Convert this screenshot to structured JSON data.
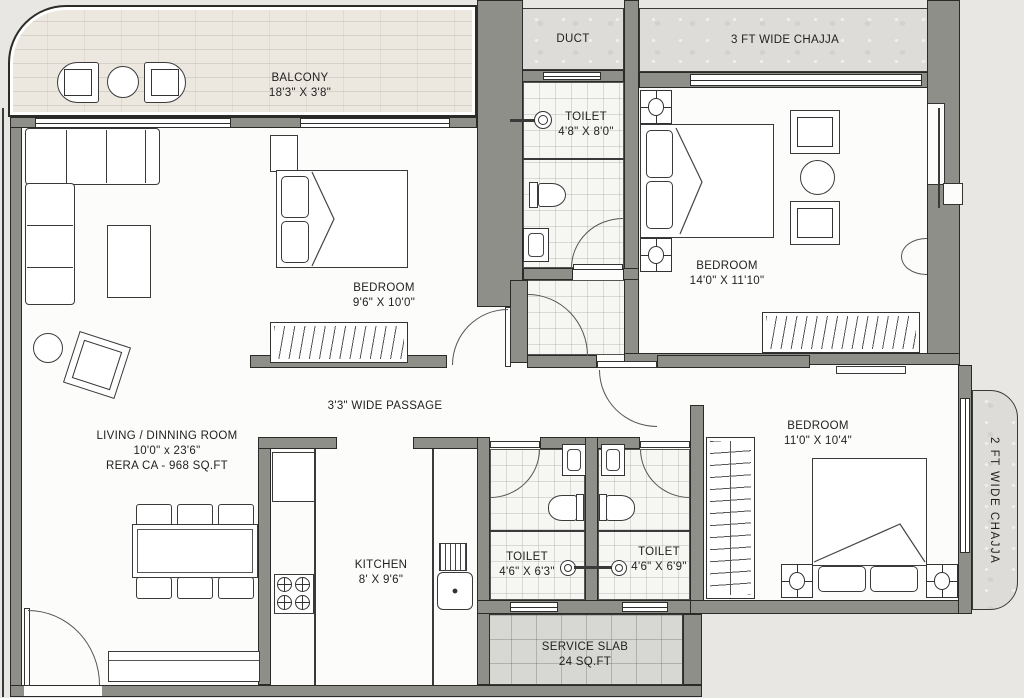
{
  "colors": {
    "background": "#e9e7e3",
    "wall": "#8f8f8a",
    "line": "#2a2a28",
    "floor": "#fcfcfa",
    "tile_floor": "#f6f6f3",
    "texture": "#dedcd8",
    "balcony_floor": "#ece8e0",
    "text": "#1f1f1f"
  },
  "rooms": {
    "balcony": {
      "label": "BALCONY",
      "dims": "18'3\" X 3'8\""
    },
    "duct": {
      "label": "DUCT"
    },
    "chajja_top": {
      "label": "3 FT WIDE CHAJJA"
    },
    "chajja_right": {
      "label": "2 FT WIDE CHAJJA"
    },
    "toilet_top": {
      "label": "TOILET",
      "dims": "4'8\" X 8'0\""
    },
    "bedroom_mid": {
      "label": "BEDROOM",
      "dims": "9'6\" X 10'0\""
    },
    "bedroom_top_right": {
      "label": "BEDROOM",
      "dims": "14'0\" X 11'10\""
    },
    "bedroom_right": {
      "label": "BEDROOM",
      "dims": "11'0\" X 10'4\""
    },
    "living": {
      "label": "LIVING / DINNING  ROOM",
      "dims": "10'0\" x 23'6\"",
      "rera": "RERA CA - 968  SQ.FT"
    },
    "passage": {
      "label": "3'3\" WIDE PASSAGE"
    },
    "kitchen": {
      "label": "KITCHEN",
      "dims": "8' X 9'6\""
    },
    "toilet_left": {
      "label": "TOILET",
      "dims": "4'6\" X 6'3\""
    },
    "toilet_right": {
      "label": "TOILET",
      "dims": "4'6\" X 6'9\""
    },
    "service_slab": {
      "label": "SERVICE SLAB",
      "dims": "24 SQ.FT"
    }
  }
}
